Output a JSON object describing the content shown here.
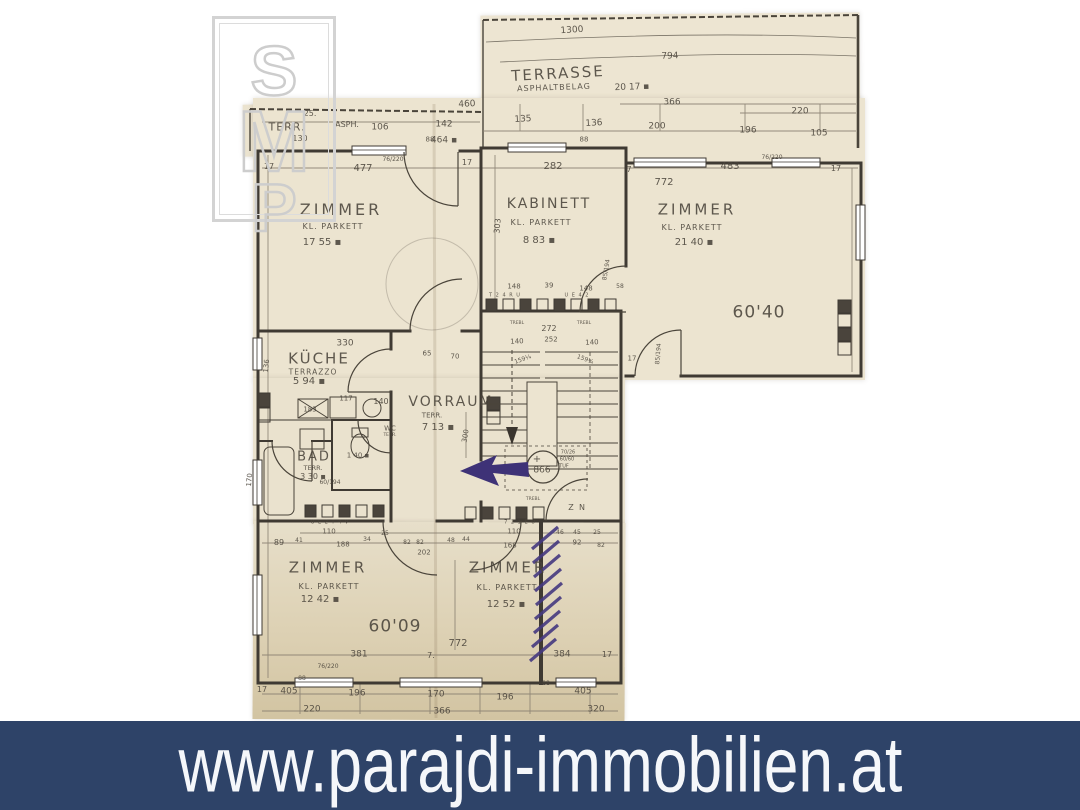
{
  "watermark": {
    "letters": [
      "S",
      "M",
      "P"
    ]
  },
  "banner": {
    "url": "www.parajdi-immobilien.at",
    "bg": "#2e4368",
    "fg": "#f5f7fa"
  },
  "plan": {
    "paper_color": "#ece4d0",
    "ink_color": "#3f3a33",
    "annotation_color": "#3e3277",
    "rooms": [
      {
        "name": "TERRASSE",
        "flooring": "ASPHALTBELAG",
        "area": "20 17"
      },
      {
        "name": "TERR.",
        "flooring": "ASPH.",
        "area": "464"
      },
      {
        "name": "ZIMMER",
        "flooring": "KL. PARKETT",
        "area": "17 55"
      },
      {
        "name": "KABINETT",
        "flooring": "KL. PARKETT",
        "area": "8 83"
      },
      {
        "name": "ZIMMER",
        "flooring": "KL. PARKETT",
        "area": "21 40"
      },
      {
        "name": "KÜCHE",
        "flooring": "TERRAZZO",
        "area": "5 94"
      },
      {
        "name": "VORRAUM",
        "flooring": "TERR.",
        "area": "7 13"
      },
      {
        "name": "BAD",
        "flooring": "TERR.",
        "area": "3 30"
      },
      {
        "name": "WC",
        "flooring": "TERR.",
        "area": "1 40"
      },
      {
        "name": "ZIMMER",
        "flooring": "KL. PARKETT",
        "area": "12 42"
      },
      {
        "name": "ZIMMER",
        "flooring": "KL. PARKETT",
        "area": "12 52"
      }
    ],
    "elevation_marks": [
      "60'40",
      "60'09",
      "866"
    ],
    "labels": [
      {
        "t": "1300",
        "x": 572,
        "y": 31,
        "s": 9,
        "r": -4
      },
      {
        "t": "794",
        "x": 670,
        "y": 57,
        "s": 9,
        "r": -2
      },
      {
        "t": "TERRASSE",
        "x": 558,
        "y": 74,
        "s": 15,
        "r": -3,
        "ls": 2
      },
      {
        "t": "ASPHALTBELAG",
        "x": 554,
        "y": 88,
        "s": 8,
        "r": -2,
        "ls": 1
      },
      {
        "t": "20 17 ▪",
        "x": 632,
        "y": 88,
        "s": 9,
        "r": -2
      },
      {
        "t": "366",
        "x": 672,
        "y": 103,
        "s": 9
      },
      {
        "t": "220",
        "x": 800,
        "y": 112,
        "s": 9
      },
      {
        "t": "135",
        "x": 523,
        "y": 120,
        "s": 9,
        "r": -3
      },
      {
        "t": "136",
        "x": 594,
        "y": 124,
        "s": 9,
        "r": -3
      },
      {
        "t": "200",
        "x": 657,
        "y": 127,
        "s": 9
      },
      {
        "t": "196",
        "x": 748,
        "y": 131,
        "s": 9
      },
      {
        "t": "105",
        "x": 819,
        "y": 134,
        "s": 9
      },
      {
        "t": "88",
        "x": 584,
        "y": 140,
        "s": 7
      },
      {
        "t": "25.",
        "x": 310,
        "y": 114,
        "s": 8
      },
      {
        "t": "TERR.",
        "x": 287,
        "y": 127,
        "s": 11,
        "ls": 1
      },
      {
        "t": "130",
        "x": 300,
        "y": 139,
        "s": 8
      },
      {
        "t": "ASPH.",
        "x": 347,
        "y": 125,
        "s": 8
      },
      {
        "t": "106",
        "x": 380,
        "y": 128,
        "s": 9
      },
      {
        "t": "142",
        "x": 444,
        "y": 125,
        "s": 9
      },
      {
        "t": "460",
        "x": 467,
        "y": 105,
        "s": 9,
        "r": -3
      },
      {
        "t": "88",
        "x": 430,
        "y": 140,
        "s": 7
      },
      {
        "t": "464 ▪",
        "x": 444,
        "y": 141,
        "s": 9
      },
      {
        "t": "17",
        "x": 269,
        "y": 167,
        "s": 8
      },
      {
        "t": "477",
        "x": 363,
        "y": 169,
        "s": 10
      },
      {
        "t": "76/220",
        "x": 393,
        "y": 160,
        "s": 6
      },
      {
        "t": "17",
        "x": 467,
        "y": 163,
        "s": 8
      },
      {
        "t": "282",
        "x": 553,
        "y": 167,
        "s": 10
      },
      {
        "t": "7",
        "x": 629,
        "y": 170,
        "s": 8
      },
      {
        "t": "483",
        "x": 730,
        "y": 167,
        "s": 10
      },
      {
        "t": "76/220",
        "x": 772,
        "y": 158,
        "s": 6
      },
      {
        "t": "17",
        "x": 836,
        "y": 169,
        "s": 8
      },
      {
        "t": "772",
        "x": 664,
        "y": 183,
        "s": 10
      },
      {
        "t": "ZIMMER",
        "x": 341,
        "y": 210,
        "s": 16,
        "ls": 3
      },
      {
        "t": "KL. PARKETT",
        "x": 333,
        "y": 227,
        "s": 8,
        "ls": 1
      },
      {
        "t": "17 55 ▪",
        "x": 322,
        "y": 243,
        "s": 10
      },
      {
        "t": "KABINETT",
        "x": 549,
        "y": 204,
        "s": 14,
        "ls": 2
      },
      {
        "t": "KL. PARKETT",
        "x": 541,
        "y": 223,
        "s": 8,
        "ls": 1
      },
      {
        "t": "8 83 ▪",
        "x": 539,
        "y": 241,
        "s": 10
      },
      {
        "t": "303",
        "x": 498,
        "y": 226,
        "s": 8,
        "r": -85
      },
      {
        "t": "ZIMMER",
        "x": 697,
        "y": 210,
        "s": 15,
        "ls": 3
      },
      {
        "t": "KL. PARKETT",
        "x": 692,
        "y": 228,
        "s": 8,
        "ls": 1
      },
      {
        "t": "21 40 ▪",
        "x": 694,
        "y": 243,
        "s": 10
      },
      {
        "t": "60'40",
        "x": 759,
        "y": 313,
        "s": 17,
        "ls": 1
      },
      {
        "t": "85/194",
        "x": 607,
        "y": 270,
        "s": 6,
        "r": -80
      },
      {
        "t": "85/194",
        "x": 659,
        "y": 354,
        "s": 6,
        "r": -85
      },
      {
        "t": "148",
        "x": 514,
        "y": 287,
        "s": 7
      },
      {
        "t": "39",
        "x": 549,
        "y": 286,
        "s": 7
      },
      {
        "t": "148",
        "x": 586,
        "y": 289,
        "s": 7
      },
      {
        "t": "58",
        "x": 620,
        "y": 287,
        "s": 6
      },
      {
        "t": "T 2 4 R U",
        "x": 505,
        "y": 296,
        "s": 5,
        "ls": 1
      },
      {
        "t": "U E 4 2",
        "x": 577,
        "y": 296,
        "s": 5,
        "ls": 1
      },
      {
        "t": "272",
        "x": 549,
        "y": 329,
        "s": 8
      },
      {
        "t": "252",
        "x": 551,
        "y": 340,
        "s": 7
      },
      {
        "t": "TREBL",
        "x": 517,
        "y": 324,
        "s": 4.5
      },
      {
        "t": "TREBL",
        "x": 584,
        "y": 324,
        "s": 4.5
      },
      {
        "t": "140",
        "x": 517,
        "y": 342,
        "s": 7,
        "r": -3
      },
      {
        "t": "140",
        "x": 592,
        "y": 343,
        "s": 7,
        "r": -3
      },
      {
        "t": "159¼",
        "x": 523,
        "y": 360,
        "s": 6,
        "r": -20
      },
      {
        "t": "159¼",
        "x": 585,
        "y": 360,
        "s": 6,
        "r": 20
      },
      {
        "t": "+",
        "x": 537,
        "y": 460,
        "s": 10
      },
      {
        "t": "866",
        "x": 542,
        "y": 471,
        "s": 9
      },
      {
        "t": "70/26",
        "x": 568,
        "y": 453,
        "s": 5
      },
      {
        "t": "60/60",
        "x": 567,
        "y": 460,
        "s": 5
      },
      {
        "t": "TUF",
        "x": 564,
        "y": 467,
        "s": 5
      },
      {
        "t": "TREBL",
        "x": 533,
        "y": 500,
        "s": 4.5
      },
      {
        "t": "Z",
        "x": 571,
        "y": 508,
        "s": 8
      },
      {
        "t": "N",
        "x": 582,
        "y": 508,
        "s": 8
      },
      {
        "t": "17",
        "x": 632,
        "y": 359,
        "s": 7
      },
      {
        "t": "330",
        "x": 345,
        "y": 344,
        "s": 9
      },
      {
        "t": "KÜCHE",
        "x": 319,
        "y": 359,
        "s": 15,
        "ls": 2
      },
      {
        "t": "TERRAZZO",
        "x": 313,
        "y": 372,
        "s": 7.5,
        "ls": 1
      },
      {
        "t": "5 94 ▪",
        "x": 309,
        "y": 382,
        "s": 10
      },
      {
        "t": "136",
        "x": 267,
        "y": 366,
        "s": 7,
        "r": -85
      },
      {
        "t": "170",
        "x": 250,
        "y": 480,
        "s": 7,
        "r": -85
      },
      {
        "t": "117",
        "x": 346,
        "y": 399,
        "s": 7
      },
      {
        "t": "140",
        "x": 381,
        "y": 402,
        "s": 8
      },
      {
        "t": "183",
        "x": 310,
        "y": 410,
        "s": 7
      },
      {
        "t": "65",
        "x": 427,
        "y": 354,
        "s": 7
      },
      {
        "t": "70",
        "x": 455,
        "y": 357,
        "s": 7
      },
      {
        "t": "VORRAUM",
        "x": 451,
        "y": 402,
        "s": 14,
        "ls": 2
      },
      {
        "t": "TERR.",
        "x": 432,
        "y": 416,
        "s": 7
      },
      {
        "t": "7 13 ▪",
        "x": 438,
        "y": 428,
        "s": 10
      },
      {
        "t": "300",
        "x": 466,
        "y": 436,
        "s": 7,
        "r": -80
      },
      {
        "t": "WC",
        "x": 390,
        "y": 429,
        "s": 7
      },
      {
        "t": "TERR.",
        "x": 390,
        "y": 436,
        "s": 4.5
      },
      {
        "t": "1 40 ▪",
        "x": 358,
        "y": 456,
        "s": 7
      },
      {
        "t": "BAD",
        "x": 314,
        "y": 457,
        "s": 13,
        "ls": 2
      },
      {
        "t": "TERR.",
        "x": 313,
        "y": 468,
        "s": 6.5
      },
      {
        "t": "3 30 ▪",
        "x": 313,
        "y": 477,
        "s": 8
      },
      {
        "t": "60/194",
        "x": 330,
        "y": 483,
        "s": 6
      },
      {
        "t": "89",
        "x": 279,
        "y": 543,
        "s": 8
      },
      {
        "t": "41",
        "x": 299,
        "y": 541,
        "s": 6
      },
      {
        "t": "110",
        "x": 329,
        "y": 532,
        "s": 7
      },
      {
        "t": "188",
        "x": 343,
        "y": 545,
        "s": 7
      },
      {
        "t": "34",
        "x": 367,
        "y": 540,
        "s": 6
      },
      {
        "t": "25",
        "x": 385,
        "y": 534,
        "s": 6
      },
      {
        "t": "82",
        "x": 407,
        "y": 543,
        "s": 6
      },
      {
        "t": "82",
        "x": 420,
        "y": 543,
        "s": 6
      },
      {
        "t": "202",
        "x": 424,
        "y": 553,
        "s": 7
      },
      {
        "t": "48",
        "x": 451,
        "y": 541,
        "s": 6
      },
      {
        "t": "44",
        "x": 466,
        "y": 540,
        "s": 6
      },
      {
        "t": "110",
        "x": 514,
        "y": 532,
        "s": 7
      },
      {
        "t": "168",
        "x": 510,
        "y": 546,
        "s": 7
      },
      {
        "t": "92",
        "x": 577,
        "y": 543,
        "s": 7
      },
      {
        "t": "82",
        "x": 601,
        "y": 546,
        "s": 6
      },
      {
        "t": "46",
        "x": 560,
        "y": 533,
        "s": 6
      },
      {
        "t": "45",
        "x": 577,
        "y": 533,
        "s": 6
      },
      {
        "t": "25",
        "x": 597,
        "y": 533,
        "s": 6
      },
      {
        "t": "U E 2 T 4 V",
        "x": 330,
        "y": 523,
        "s": 5,
        "ls": 1
      },
      {
        "t": "7 2 1 E U",
        "x": 520,
        "y": 523,
        "s": 5,
        "ls": 1
      },
      {
        "t": "ZIMMER",
        "x": 328,
        "y": 568,
        "s": 15,
        "ls": 3
      },
      {
        "t": "KL. PARKETT",
        "x": 329,
        "y": 587,
        "s": 8,
        "ls": 1
      },
      {
        "t": "12 42 ▪",
        "x": 320,
        "y": 600,
        "s": 10
      },
      {
        "t": "ZIMMER",
        "x": 508,
        "y": 568,
        "s": 15,
        "ls": 3
      },
      {
        "t": "KL. PARKETT",
        "x": 507,
        "y": 588,
        "s": 8,
        "ls": 1
      },
      {
        "t": "12 52 ▪",
        "x": 506,
        "y": 605,
        "s": 10
      },
      {
        "t": "60'09",
        "x": 395,
        "y": 627,
        "s": 17,
        "ls": 1
      },
      {
        "t": "772",
        "x": 458,
        "y": 644,
        "s": 10
      },
      {
        "t": "381",
        "x": 359,
        "y": 655,
        "s": 9
      },
      {
        "t": "7.",
        "x": 431,
        "y": 656,
        "s": 8
      },
      {
        "t": "384",
        "x": 562,
        "y": 655,
        "s": 9
      },
      {
        "t": "17",
        "x": 607,
        "y": 655,
        "s": 8
      },
      {
        "t": "76/220",
        "x": 328,
        "y": 667,
        "s": 6
      },
      {
        "t": "88",
        "x": 302,
        "y": 679,
        "s": 6
      },
      {
        "t": "88",
        "x": 546,
        "y": 684,
        "s": 6
      },
      {
        "t": "17",
        "x": 262,
        "y": 690,
        "s": 8
      },
      {
        "t": "405",
        "x": 289,
        "y": 692,
        "s": 9
      },
      {
        "t": "196",
        "x": 357,
        "y": 694,
        "s": 9
      },
      {
        "t": "170",
        "x": 436,
        "y": 695,
        "s": 9
      },
      {
        "t": "196",
        "x": 505,
        "y": 698,
        "s": 9
      },
      {
        "t": "405",
        "x": 583,
        "y": 692,
        "s": 9
      },
      {
        "t": "220",
        "x": 312,
        "y": 710,
        "s": 9
      },
      {
        "t": "366",
        "x": 442,
        "y": 712,
        "s": 9
      },
      {
        "t": "320",
        "x": 596,
        "y": 710,
        "s": 9
      }
    ]
  }
}
